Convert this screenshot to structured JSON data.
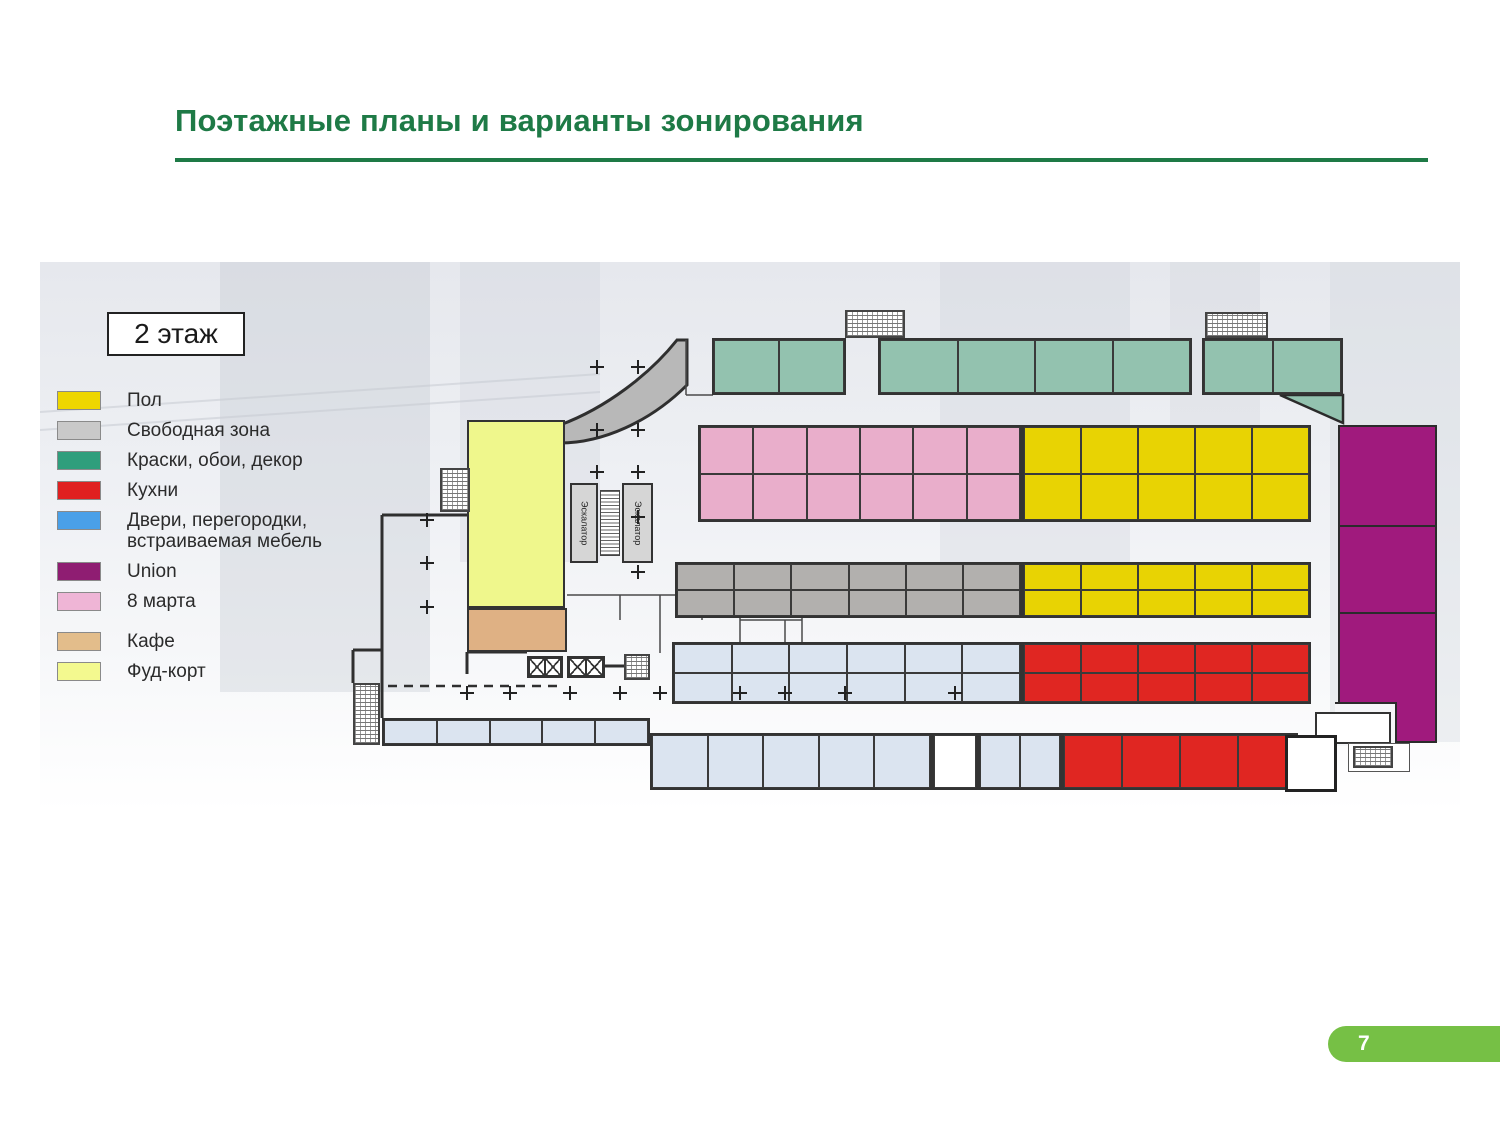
{
  "slide": {
    "title": "Поэтажные планы и варианты зонирования",
    "page_number": "7",
    "accent_color": "#1e7a46",
    "badge_color": "#76c045"
  },
  "plan": {
    "floor_label": "2 этаж",
    "escalator_label": "Эскалатор",
    "legend": [
      {
        "key": "yellow",
        "label": "Пол",
        "color": "#eed600",
        "gap_before": false
      },
      {
        "key": "gray",
        "label": "Свободная зона",
        "color": "#c9c9c9",
        "gap_before": false
      },
      {
        "key": "green",
        "label": "Краски, обои, декор",
        "color": "#2f9e7c",
        "gap_before": false
      },
      {
        "key": "red",
        "label": "Кухни",
        "color": "#e02020",
        "gap_before": false
      },
      {
        "key": "blue",
        "label": "Двери, перегородки, встраиваемая мебель",
        "color": "#4aa0e8",
        "gap_before": false
      },
      {
        "key": "union",
        "label": "Union",
        "color": "#8f1d72",
        "gap_before": false
      },
      {
        "key": "pink",
        "label": "8 марта",
        "color": "#efb5d6",
        "gap_before": false
      },
      {
        "key": "cafe",
        "label": "Кафе",
        "color": "#e3bd8b",
        "gap_before": true
      },
      {
        "key": "foodcourt",
        "label": "Фуд-корт",
        "color": "#f3f98f",
        "gap_before": false
      }
    ],
    "plan_colors": {
      "green": "#93c2af",
      "pink": "#e9aecb",
      "yellow": "#e8d303",
      "gray": "#b2b0ae",
      "blue": "#dbe4f0",
      "red": "#e02622",
      "union": "#a01a7d",
      "cafe": "#dfb184",
      "foodcourt": "#eff78c",
      "free": "#b8b8b8",
      "white": "#ffffff"
    },
    "bands": [
      {
        "y": 76,
        "h": 57,
        "rows": 1,
        "segments": [
          {
            "x": 672,
            "w": 134,
            "cells": 2,
            "color": "green"
          },
          {
            "x": 838,
            "w": 314,
            "cells": 4,
            "color": "green"
          },
          {
            "x": 1162,
            "w": 141,
            "cells": 2,
            "color": "green"
          }
        ]
      },
      {
        "y": 163,
        "h": 97,
        "rows": 2,
        "segments": [
          {
            "x": 658,
            "w": 324,
            "cells": 6,
            "color": "pink"
          },
          {
            "x": 982,
            "w": 289,
            "cells": 5,
            "color": "yellow"
          }
        ]
      },
      {
        "y": 300,
        "h": 56,
        "rows": 2,
        "segments": [
          {
            "x": 635,
            "w": 347,
            "cells": 6,
            "color": "gray"
          },
          {
            "x": 982,
            "w": 289,
            "cells": 5,
            "color": "yellow"
          }
        ]
      },
      {
        "y": 380,
        "h": 62,
        "rows": 2,
        "segments": [
          {
            "x": 632,
            "w": 350,
            "cells": 6,
            "color": "blue"
          },
          {
            "x": 982,
            "w": 289,
            "cells": 5,
            "color": "red"
          }
        ]
      },
      {
        "y": 456,
        "h": 28,
        "rows": 1,
        "segments": [
          {
            "x": 342,
            "w": 268,
            "cells": 5,
            "color": "blue"
          }
        ]
      },
      {
        "y": 471,
        "h": 57,
        "rows": 1,
        "segments": [
          {
            "x": 610,
            "w": 282,
            "cells": 5,
            "color": "blue"
          },
          {
            "x": 892,
            "w": 46,
            "cells": 1,
            "color": "white"
          },
          {
            "x": 938,
            "w": 84,
            "cells": 2,
            "color": "blue"
          },
          {
            "x": 1022,
            "w": 236,
            "cells": 4,
            "color": "red"
          }
        ]
      }
    ],
    "union_column": {
      "x": 1298,
      "y": 163,
      "w": 99,
      "h": 318,
      "dividers": [
        98,
        185
      ],
      "notch": {
        "y": 277,
        "w": 62
      }
    },
    "blocks": [
      {
        "name": "foodcourt-zone",
        "x": 427,
        "y": 158,
        "w": 98,
        "h": 188,
        "color": "foodcourt"
      },
      {
        "name": "cafe-zone",
        "x": 427,
        "y": 346,
        "w": 100,
        "h": 44,
        "color": "cafe"
      }
    ]
  }
}
